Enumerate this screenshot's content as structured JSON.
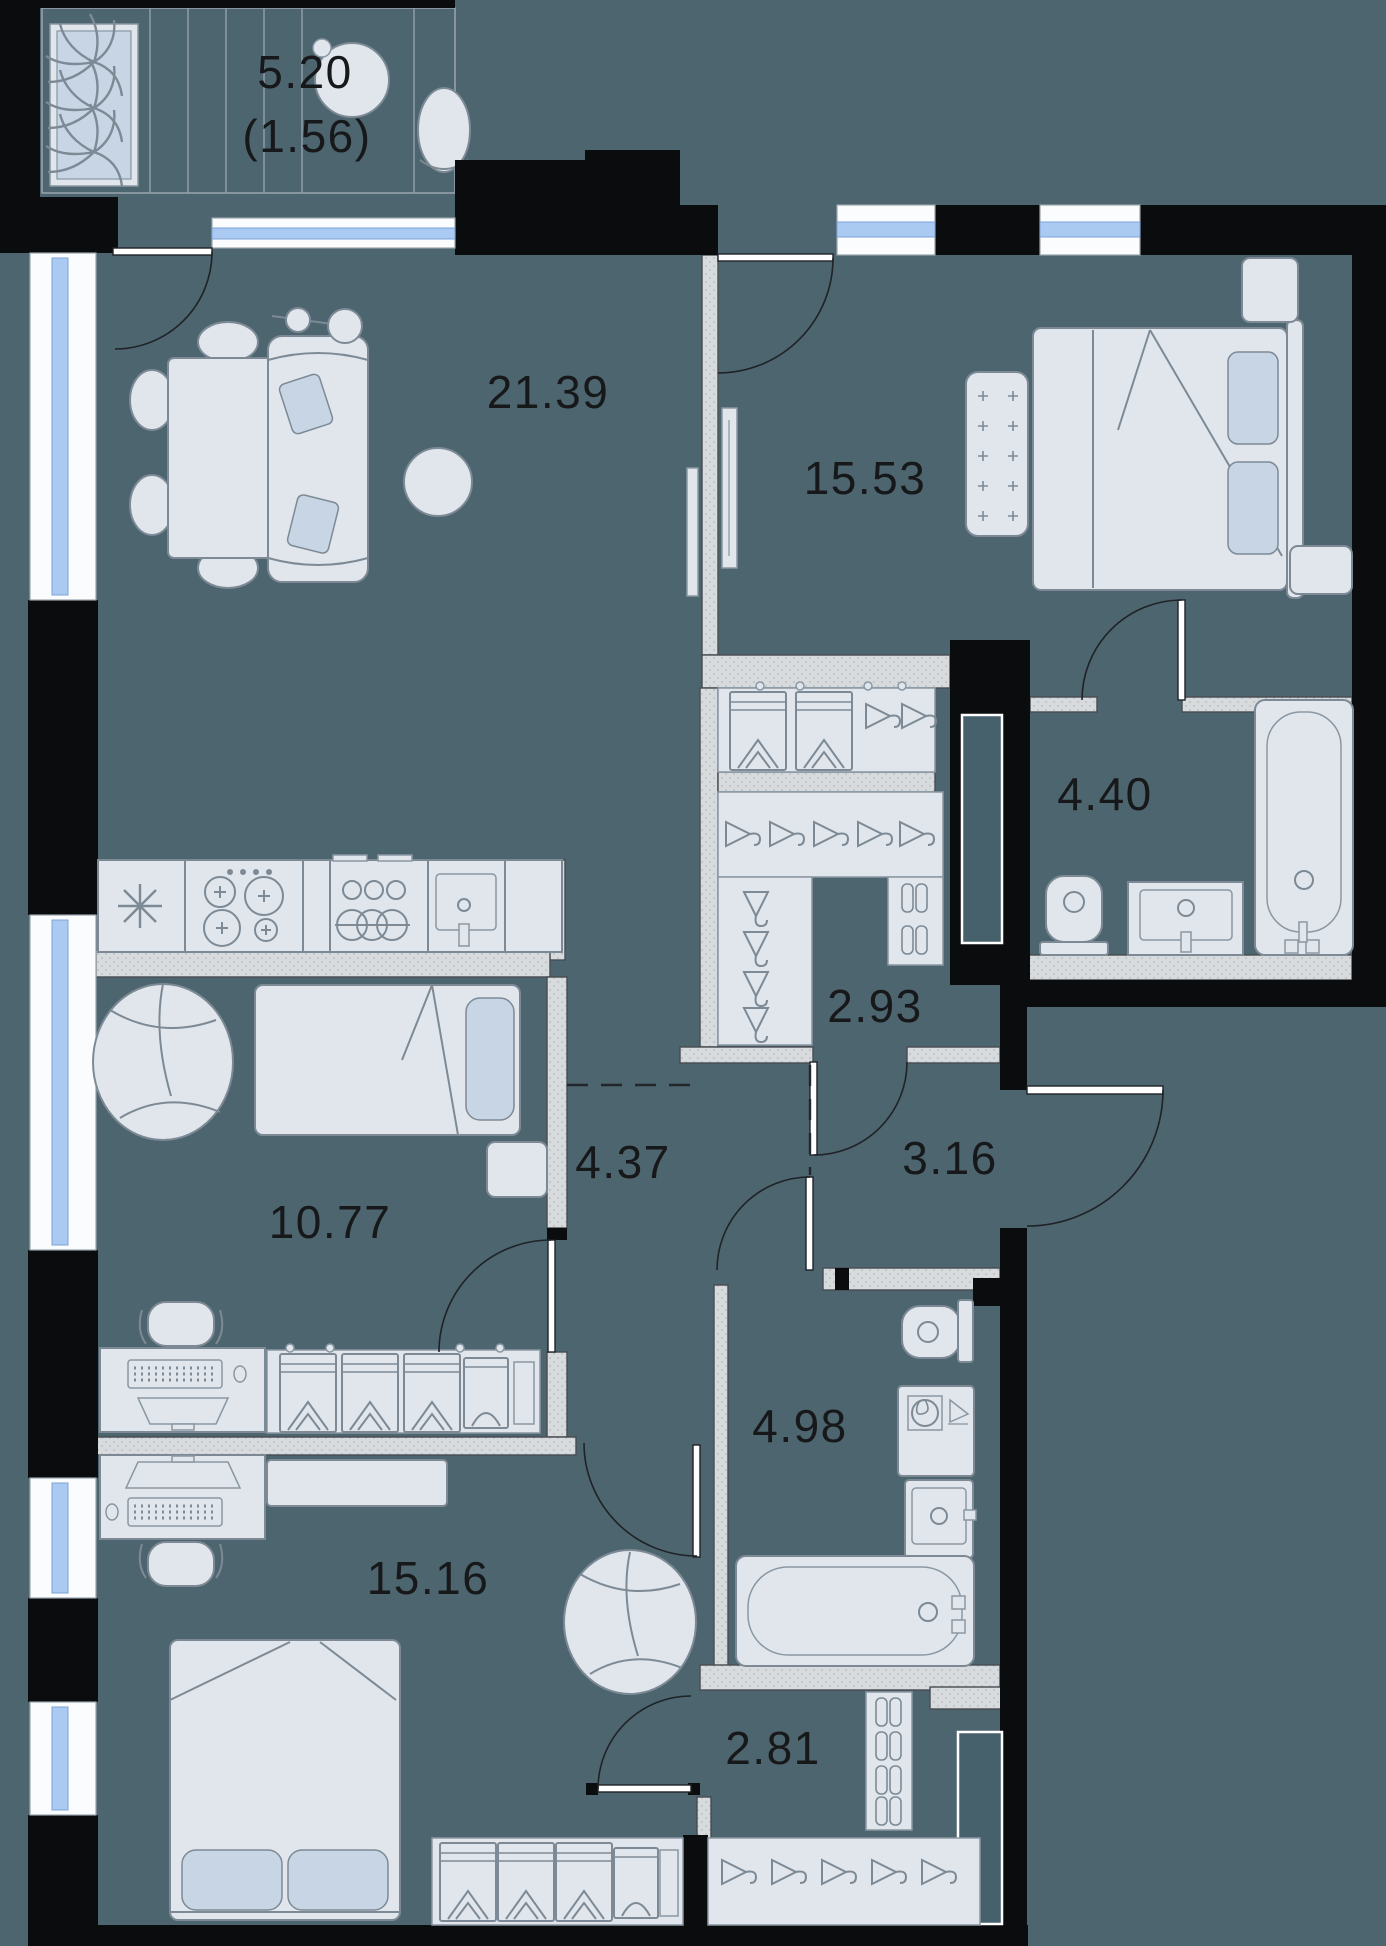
{
  "plan": {
    "type": "apartment-floor-plan",
    "rooms": [
      {
        "id": "balcony",
        "area": "5.20",
        "area_reduced": "(1.56)"
      },
      {
        "id": "living-kitchen",
        "area": "21.39"
      },
      {
        "id": "bedroom",
        "area": "15.53"
      },
      {
        "id": "bathroom-ensuite",
        "area": "4.40"
      },
      {
        "id": "walk-in-closet",
        "area": "2.93"
      },
      {
        "id": "corridor",
        "area": "4.37"
      },
      {
        "id": "hallway",
        "area": "3.16"
      },
      {
        "id": "kids-room",
        "area": "10.77"
      },
      {
        "id": "bathroom",
        "area": "4.98"
      },
      {
        "id": "bedroom-second",
        "area": "15.16"
      },
      {
        "id": "entry",
        "area": "2.81"
      }
    ],
    "colors": {
      "floor": "#4d656f",
      "wall": "#0b0c0e",
      "partition": "#d8dbde",
      "furniture": "#e0e6ec",
      "furniture_stroke": "#7d8a96",
      "textile_accent": "#c7d5e4",
      "window_glass": "#abcaf1",
      "label_text": "#17181a"
    }
  }
}
